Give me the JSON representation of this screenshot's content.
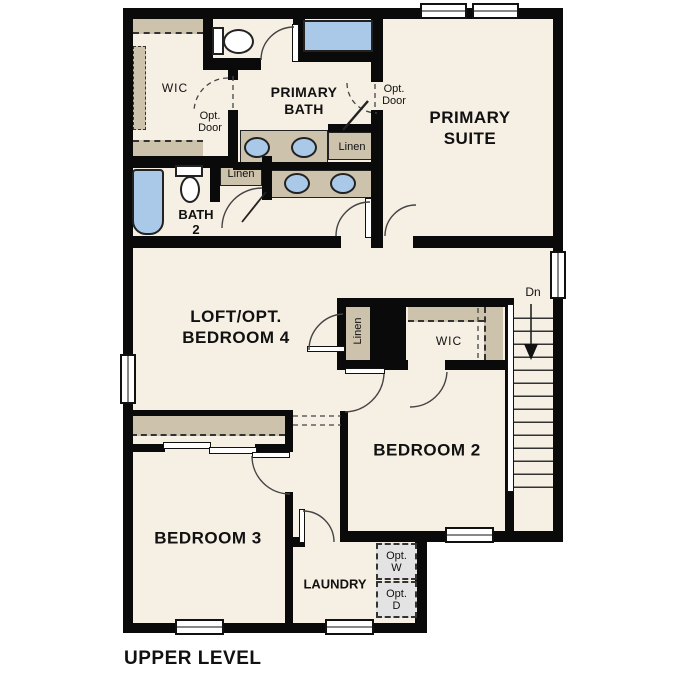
{
  "title": "UPPER LEVEL",
  "rooms": {
    "primary_suite": [
      "PRIMARY",
      "SUITE"
    ],
    "primary_bath": [
      "PRIMARY",
      "BATH"
    ],
    "bath_2": [
      "BATH",
      "2"
    ],
    "loft": [
      "LOFT/OPT.",
      "BEDROOM 4"
    ],
    "bedroom_2": "BEDROOM 2",
    "bedroom_3": "BEDROOM 3",
    "laundry": "LAUNDRY"
  },
  "labels": {
    "wic": "WIC",
    "linen": "Linen",
    "opt_door": [
      "Opt.",
      "Door"
    ],
    "dn": "Dn",
    "opt_washer": [
      "Opt.",
      "W"
    ],
    "opt_dryer": [
      "Opt.",
      "D"
    ]
  },
  "colors": {
    "floor": "#f6efe4",
    "wall": "#0a0a0a",
    "casework": "#cdc2ab",
    "fixture_blue": "#aac9e9",
    "appliance_gray": "#e3e3e3"
  }
}
